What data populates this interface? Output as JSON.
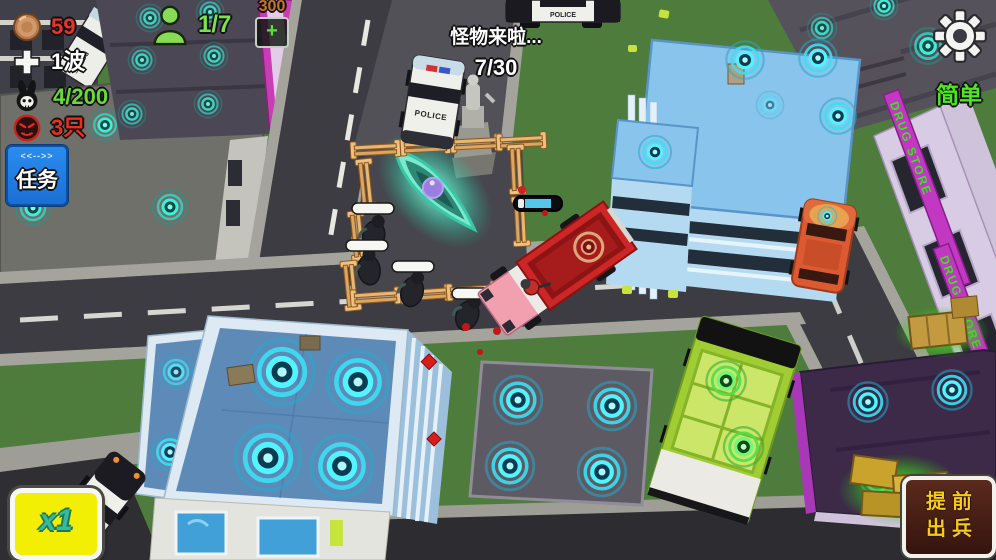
{
  "meta": {
    "width": 996,
    "height": 560,
    "app": "voxel-city-defense-game"
  },
  "hud": {
    "coins": {
      "icon": "coin-icon",
      "value": "59"
    },
    "wave": {
      "icon": "heal-cross-icon",
      "value": "1波"
    },
    "kills": {
      "icon": "rabbit-skull-icon",
      "value": "4/200"
    },
    "monsters_left": {
      "icon": "monster-head-icon",
      "value": "3只"
    },
    "population": {
      "icon": "person-icon",
      "value": "1/7"
    },
    "supply": {
      "value": "300",
      "add_button": "+"
    },
    "announcement": {
      "title": "怪物来啦...",
      "progress": "7/30"
    },
    "mission_button": {
      "decoration": "<<-->>",
      "label": "任务"
    },
    "difficulty_label": "简单",
    "settings": {
      "icon": "gear-icon"
    },
    "speed_button_label": "x1",
    "deploy_button": {
      "line1": "提前",
      "line2": "出兵"
    }
  },
  "scene": {
    "police_label": "POLICE",
    "drug_store_label": "DRUG STORE",
    "hero_health_percent": 65,
    "zombie_count_visible": 4
  },
  "colors": {
    "grass": "#4e7c3d",
    "road": "#3c3c42",
    "coin_value": "#e8342a",
    "wave_value": "#ffffff",
    "kills_value": "#66dc34",
    "monsters_value": "#f22c1c",
    "population_value": "#7de04c",
    "supply_value": "#c8742a",
    "difficulty": "#4ce81c",
    "mission_bg": "#1f7fe8",
    "speed_bg": "#f2ee04",
    "speed_text": "#38b8a0",
    "deploy_bg": "#44201a",
    "deploy_text": "#f6ca16",
    "portal_cyan": "#3ae0f4",
    "portal_teal": "#2ed8c4",
    "portal_green": "#48e050",
    "fire_truck": "#cc2626",
    "crystal_core": "#9b7fe0"
  }
}
